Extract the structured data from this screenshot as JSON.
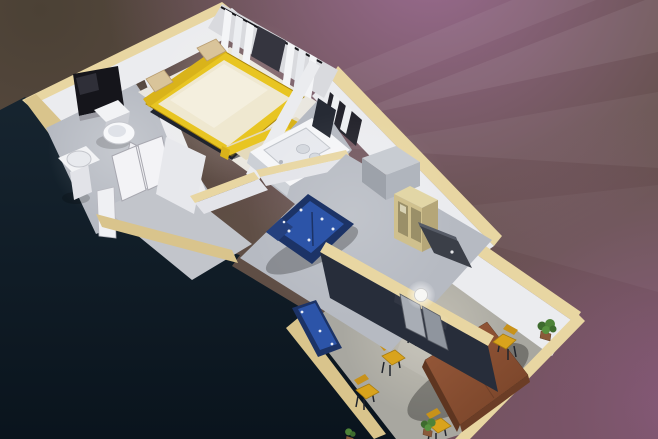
{
  "scene": {
    "type": "3d-floorplan-render",
    "description": "Elevated oblique cutaway rendering of a furnished apartment, rotated diagonally, on a dark navy and purple-brown backdrop with faint light rays",
    "rooms": [
      {
        "name": "toilet-room",
        "furniture": [
          "toilet",
          "pedestal-sink",
          "dark-wall-window",
          "door"
        ]
      },
      {
        "name": "bedroom",
        "furniture": [
          "yellow-frame-double-bed",
          "two-pillows",
          "yellow-bench",
          "white-curtains",
          "curtain-rod"
        ]
      },
      {
        "name": "bathroom",
        "furniture": [
          "white-counter-tub",
          "sink-bowls",
          "faucet",
          "dark-niche",
          "frame-window"
        ]
      },
      {
        "name": "hallway",
        "furniture": [
          "double-door",
          "open-door-leaf",
          "wall-panel"
        ]
      },
      {
        "name": "living-room",
        "furniture": [
          "blue-sofa",
          "blue-bench-sofa",
          "gray-storage-box",
          "tan-display-cabinet",
          "dark-media-unit",
          "wall-sphere-lamp",
          "doorway-doors"
        ]
      },
      {
        "name": "dining-room",
        "furniture": [
          "brown-dining-table",
          "yellow-chairs",
          "potted-plants",
          "floor-light-pool"
        ]
      }
    ],
    "counts": {
      "dining_chairs": 5,
      "potted_plants": 3,
      "sofas": 2,
      "beds": 1
    },
    "view": "bird's-eye oblique, walls cut away on the lower-left side"
  },
  "background": {
    "bottom_left": "#0e1b28",
    "top_left_olive": "#4b4135",
    "base_brown": "#5f4e45",
    "purple_top": "#96688e",
    "purple_right": "#8a5a7e",
    "light_rays": "#ffffff"
  },
  "palette": {
    "wallWhite": "#ebecef",
    "wallTopTan": "#e8d6a2",
    "wallTanLit": "#d9c48c",
    "floorGray": "#b6bac2",
    "floorDining": "#a8a7a0",
    "bedYellow": "#e8c522",
    "mattressCream": "#efe8d0",
    "pillowTan": "#d9c49a",
    "sofaBlue": "#2c54a8",
    "sofaNavy": "#1c3366",
    "tableBrown": "#8a5132",
    "chairYellow": "#d9a31c",
    "cabinetTan": "#cfc08e",
    "darkWall": "#272d3a",
    "windowDark": "#15151b",
    "plantGreen": "#4e8338",
    "baseBrown": "#5f4e45",
    "navyDark": "#0e1b28",
    "oliveTL": "#4b4135",
    "purpleTop": "#96688e",
    "purpleRight": "#8a5a7e"
  }
}
